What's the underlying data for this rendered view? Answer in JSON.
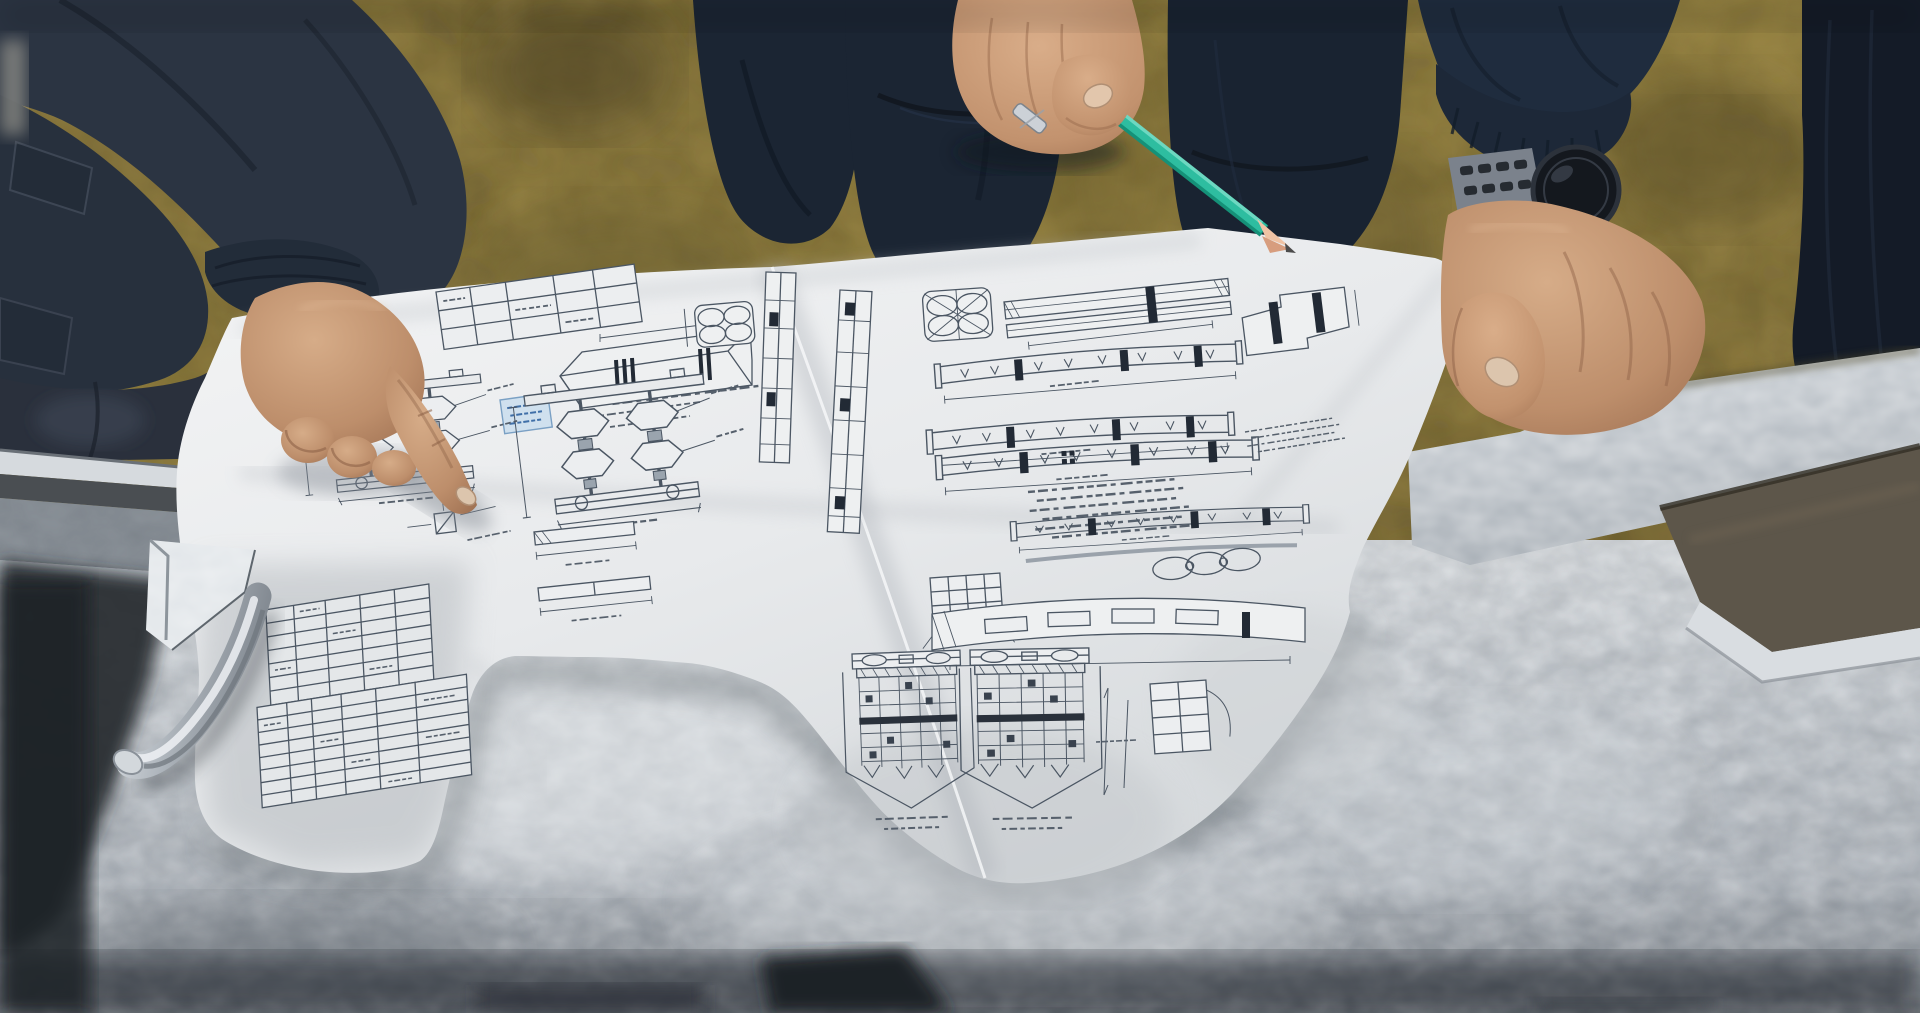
{
  "scene": {
    "type": "photograph",
    "setting": "workshop with mottled olive concrete floor",
    "subject": "three workers reviewing a folded technical engineering drawing laid over a galvanized steel beam",
    "people": {
      "left_worker": {
        "label": "worker in dark jacket pointing with index finger",
        "clothing_color": "#2b3442"
      },
      "middle_worker": {
        "label": "worker in navy workwear holding a pencil",
        "clothing_color": "#1b2736",
        "accessory": "silver ring"
      },
      "right_worker": {
        "label": "worker arm with smartwatch gripping the sheet corner",
        "clothing_color": "#141b27"
      }
    },
    "objects": {
      "drawing_sheet": {
        "label": "folded white engineering drawing, printed upside-down to viewer, illegible fine print",
        "paper_color": "#e9ebee",
        "ink_color": "#4b5663",
        "stamp_color": "#cfe0ee"
      },
      "pencil": {
        "label": "teal pencil with sharpened tip",
        "body_color": "#2fbfa2",
        "wood_color": "#e7b295",
        "lead_color": "#4b4b4b"
      },
      "smartwatch": {
        "label": "dark sport smartwatch",
        "strap_color": "#7b828c",
        "face_color": "#14181e"
      },
      "steel_beam": {
        "label": "galvanized steel beam with spangled finish",
        "bright_color": "#dfe3e6",
        "mid_color": "#b9c0c7",
        "channel_color": "#5d564a"
      },
      "steel_rod": {
        "label": "bent steel rod handle below the beam edge",
        "color": "#b8bfc6"
      },
      "floor": {
        "label": "olive-tan mottled floor",
        "color": "#8a7940"
      }
    },
    "aria": {
      "photo": "Workers pointing at a technical drawing on a steel beam",
      "floor": "workshop floor",
      "left_worker": "left worker pointing at drawing",
      "middle_worker": "middle worker holding teal pencil",
      "right_arm": "arm with smartwatch holding paper corner",
      "right_worker": "worker at right edge",
      "beam": "galvanized steel beam",
      "sheet": "folded engineering drawing sheet",
      "rod": "bent steel rod",
      "pencil": "teal pencil",
      "watch": "smartwatch"
    }
  }
}
